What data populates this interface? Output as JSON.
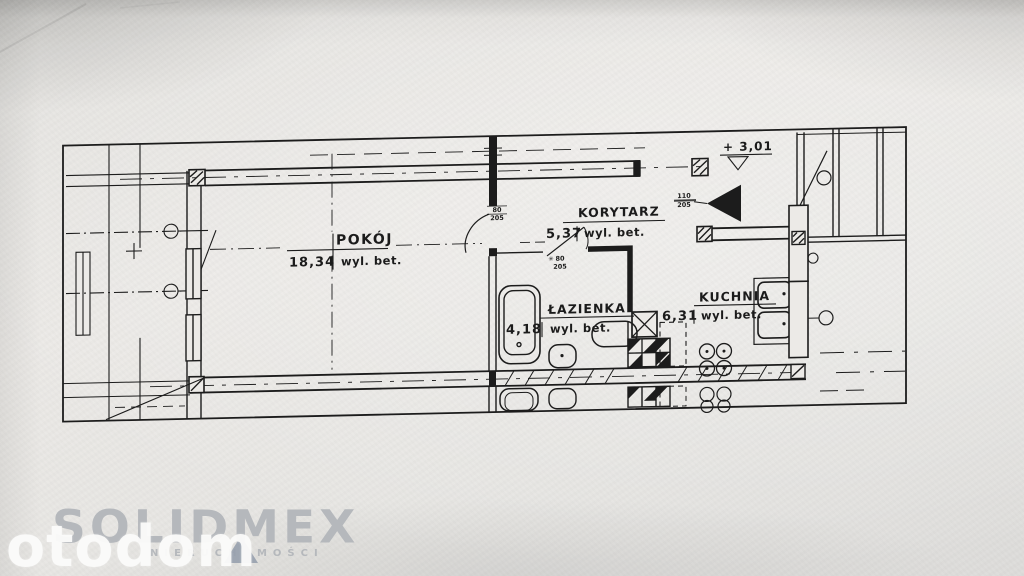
{
  "document": {
    "type": "apartment-floor-plan-photo"
  },
  "plan": {
    "rooms": [
      {
        "id": "pokoj",
        "name": "POKÓJ",
        "area": "18,34",
        "unit": "wyl. bet."
      },
      {
        "id": "korytarz",
        "name": "KORYTARZ",
        "area": "5,37",
        "unit": "wyl. bet."
      },
      {
        "id": "lazienka",
        "name": "ŁAZIENKA",
        "area": "4,18",
        "unit": "wyl. bet."
      },
      {
        "id": "kuchnia",
        "name": "KUCHNIA",
        "area": "6,31",
        "unit": "wyl. bet."
      }
    ],
    "elevation_mark": "+ 3,01",
    "door_labels": [
      {
        "location": "room-door",
        "width": "80",
        "height": "205"
      },
      {
        "location": "bathroom-door",
        "width": "80",
        "height": "205"
      },
      {
        "location": "entrance-door",
        "width": "110",
        "height": "205"
      }
    ],
    "door_symbol": "✳"
  },
  "watermark": {
    "text": "otodom"
  },
  "agency_logo": {
    "name": "SOLIDMEX",
    "subtitle": "NIERUCHOMOŚCI"
  },
  "colors": {
    "ink": "#1c1c1c",
    "paper": "#e8e7e4",
    "watermark_text": "#fcfcfb",
    "logo_text": "#b5b8bc",
    "logo_triangle": "#97a0ad"
  }
}
